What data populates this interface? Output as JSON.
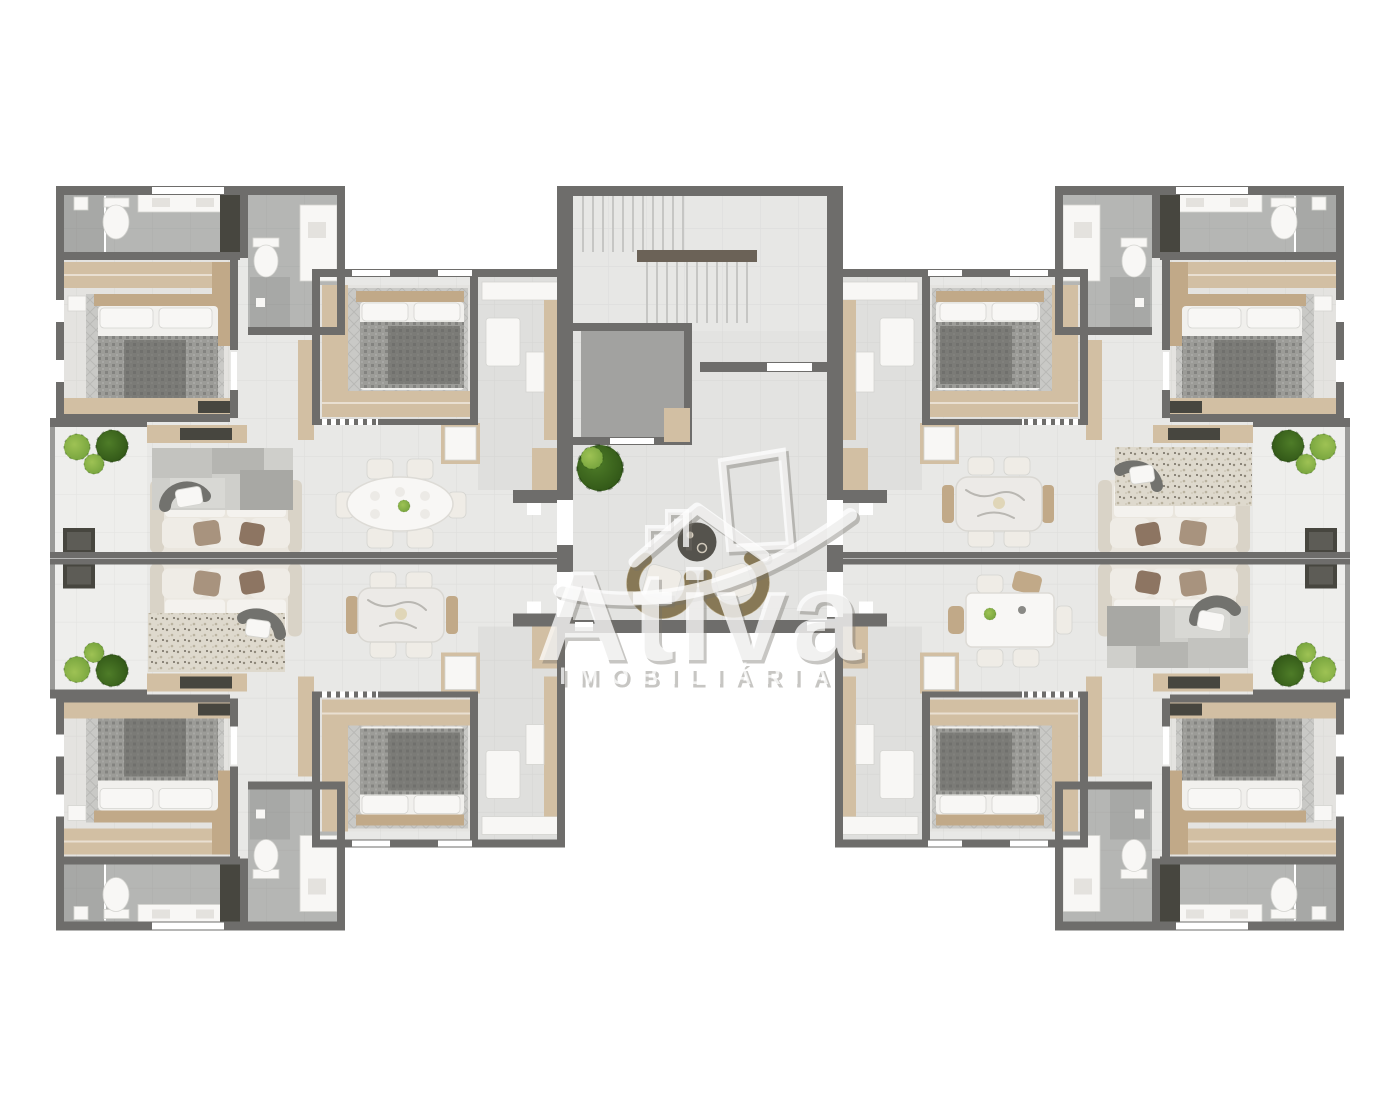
{
  "watermark": {
    "brand": "Ativa",
    "tagline": "IMOBILIÁRIA",
    "logo_icon": "buildings-roof-swoosh-logo"
  },
  "scene": {
    "type": "residential-floor-plan-render",
    "view": "top-down",
    "units_visible": 4,
    "core": "central-stair-elevator-lobby"
  },
  "palette": {
    "bg": "#ffffff",
    "wall": "#6e6d6b",
    "wallLight": "#9a9a98",
    "floor": "#e8e8e6",
    "floorWarm": "#e4e3e0",
    "floorBath": "#b5b6b4",
    "floorBathDark": "#a7a8a6",
    "floorKitchen": "#dfdfdd",
    "floorBalcony": "#eeeeec",
    "floorLobby": "#e3e3e1",
    "floorStairs": "#e7e7e5",
    "elevator": "#a2a2a0",
    "tread": "#c6c6c4",
    "wood": "#d2bfa3",
    "woodDark": "#c1a988",
    "white": "#f8f7f5",
    "cream": "#efece6",
    "sofa": "#eae6de",
    "sofaShadow": "#d9d3c7",
    "pillowTaupe": "#a8937e",
    "pillowBrown": "#8d7562",
    "duvet": "#9c9c98",
    "duvetDark": "#60605c",
    "sheet": "#f1f0ed",
    "rugGray": "#c9c9c6",
    "rugSpeckle": "#ded9cd",
    "charcoal": "#47463f",
    "curve": "#72726e",
    "plantBright": "#9ec254",
    "plantMid": "#74a23c",
    "plantDark": "#4e7c28",
    "wicker": "#b4a47e",
    "marble": "#eceae7",
    "vein": "#b9b7b2",
    "railWood": "#6b6257",
    "wmWhite": "rgba(255,255,255,0.75)",
    "wmShadow": "rgba(115,112,105,0.40)"
  }
}
